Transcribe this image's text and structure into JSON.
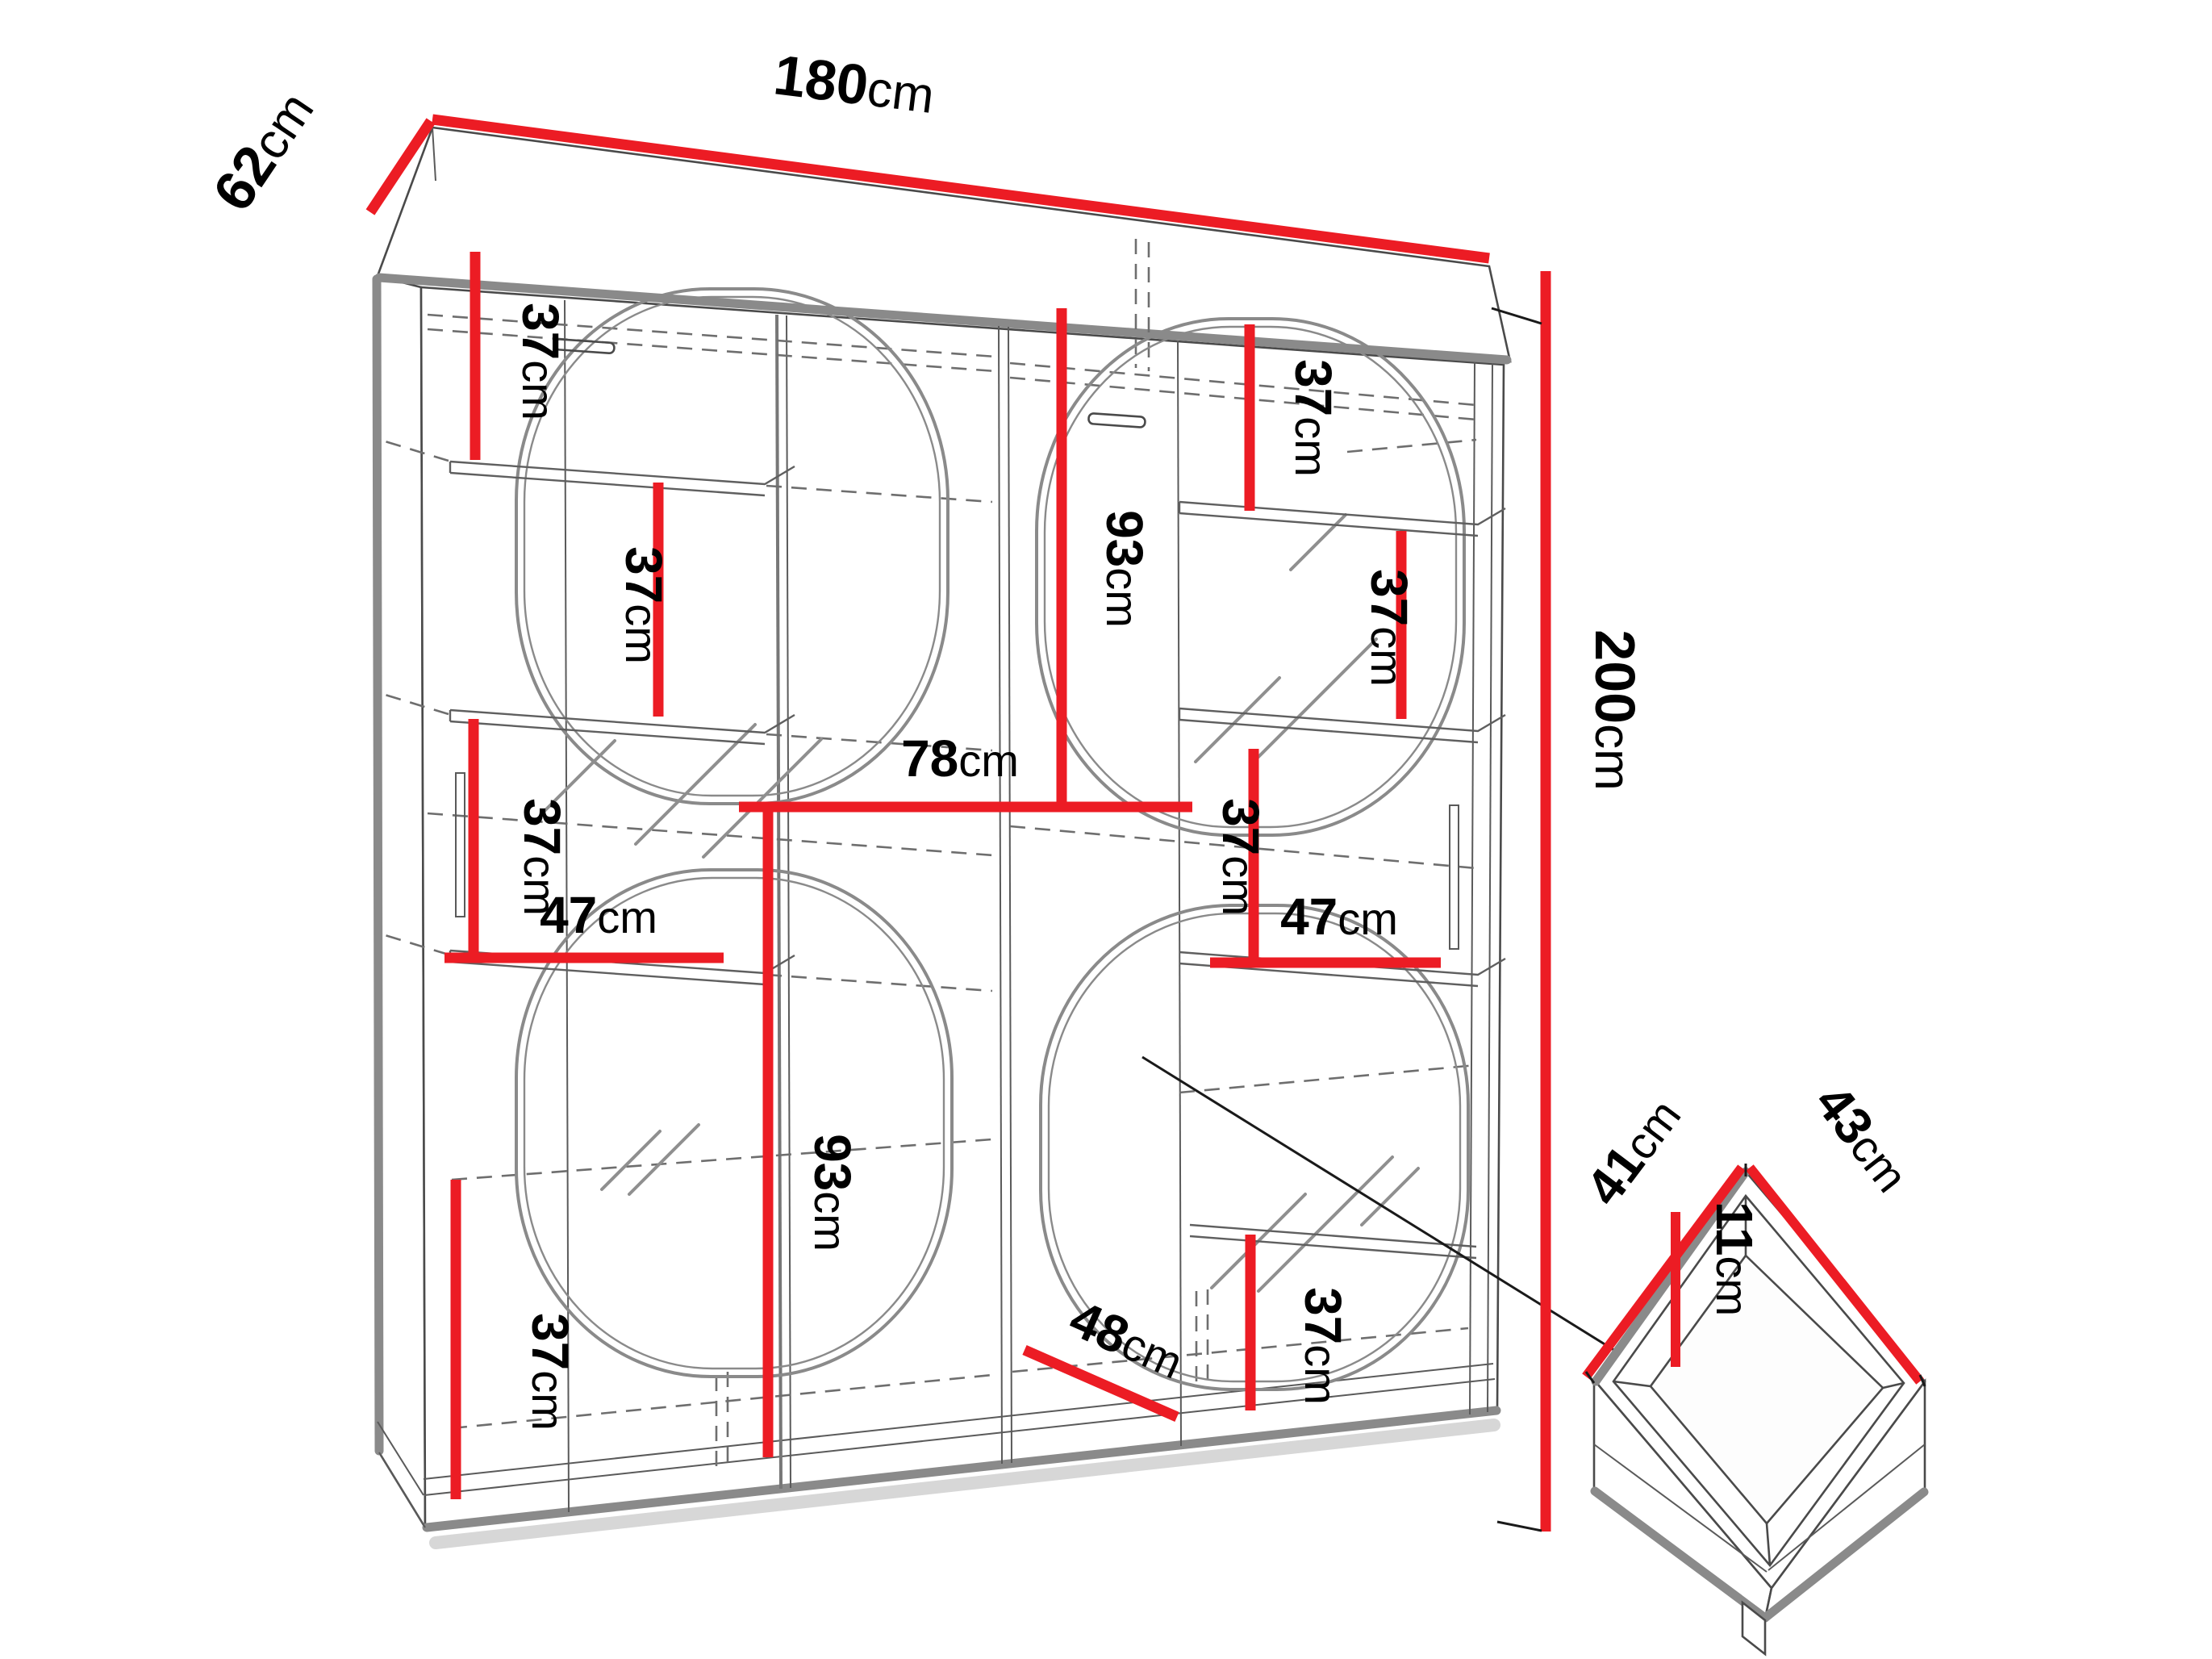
{
  "meta": {
    "title": "Sliding-door wardrobe dimension diagram with drawer detail",
    "style": "technical line drawing, red dimension lines"
  },
  "palette": {
    "dimension_red": "#EC1C24",
    "outline_dark": "#4a4a4a",
    "outline_gray": "#8a8a8a",
    "dashed_gray": "#6e6e6e",
    "background": "#ffffff",
    "text": "#000000"
  },
  "units": "cm",
  "wardrobe": {
    "overall": {
      "width_cm": 180,
      "depth_cm": 62,
      "height_cm": 200
    },
    "internal": {
      "door_opening_width_cm": 78,
      "shelf_width_cm": 47,
      "shelf_spacing_cm": 37,
      "mirror_section_height_cm": 93,
      "bottom_section_width_cm": 48
    }
  },
  "drawer": {
    "depth_cm": 41,
    "width_cm": 43,
    "internal_height_cm": 11
  },
  "dims": {
    "d180": {
      "num": "180",
      "unit": "cm"
    },
    "d62": {
      "num": "62",
      "unit": "cm"
    },
    "d200": {
      "num": "200",
      "unit": "cm"
    },
    "d37": {
      "num": "37",
      "unit": "cm"
    },
    "d47": {
      "num": "47",
      "unit": "cm"
    },
    "d78": {
      "num": "78",
      "unit": "cm"
    },
    "d93": {
      "num": "93",
      "unit": "cm"
    },
    "d48": {
      "num": "48",
      "unit": "cm"
    },
    "d41": {
      "num": "41",
      "unit": "cm"
    },
    "d43": {
      "num": "43",
      "unit": "cm"
    },
    "d11": {
      "num": "11",
      "unit": "cm"
    }
  },
  "occurrences": [
    {
      "label": "180cm",
      "location": "top front edge - overall width"
    },
    {
      "label": "62cm",
      "location": "top left edge - overall depth"
    },
    {
      "label": "200cm",
      "location": "right side - overall height"
    },
    {
      "label": "37cm",
      "location": "left column, top shelf spacing"
    },
    {
      "label": "37cm",
      "location": "left column, middle shelf spacing"
    },
    {
      "label": "37cm",
      "location": "left column, lower shelf spacing"
    },
    {
      "label": "47cm",
      "location": "left shelf width"
    },
    {
      "label": "78cm",
      "location": "left door opening width"
    },
    {
      "label": "93cm",
      "location": "left lower mirror section height"
    },
    {
      "label": "93cm",
      "location": "right upper mirror section height"
    },
    {
      "label": "37cm",
      "location": "right column, top shelf spacing"
    },
    {
      "label": "37cm",
      "location": "right mirror side shelf spacing"
    },
    {
      "label": "37cm",
      "location": "right column, middle shelf spacing"
    },
    {
      "label": "47cm",
      "location": "right shelf width"
    },
    {
      "label": "37cm",
      "location": "bottom left shelf spacing"
    },
    {
      "label": "37cm",
      "location": "bottom right shelf spacing"
    },
    {
      "label": "48cm",
      "location": "bottom interior width"
    },
    {
      "label": "41cm",
      "location": "drawer depth"
    },
    {
      "label": "43cm",
      "location": "drawer width"
    },
    {
      "label": "11cm",
      "location": "drawer internal height"
    }
  ]
}
